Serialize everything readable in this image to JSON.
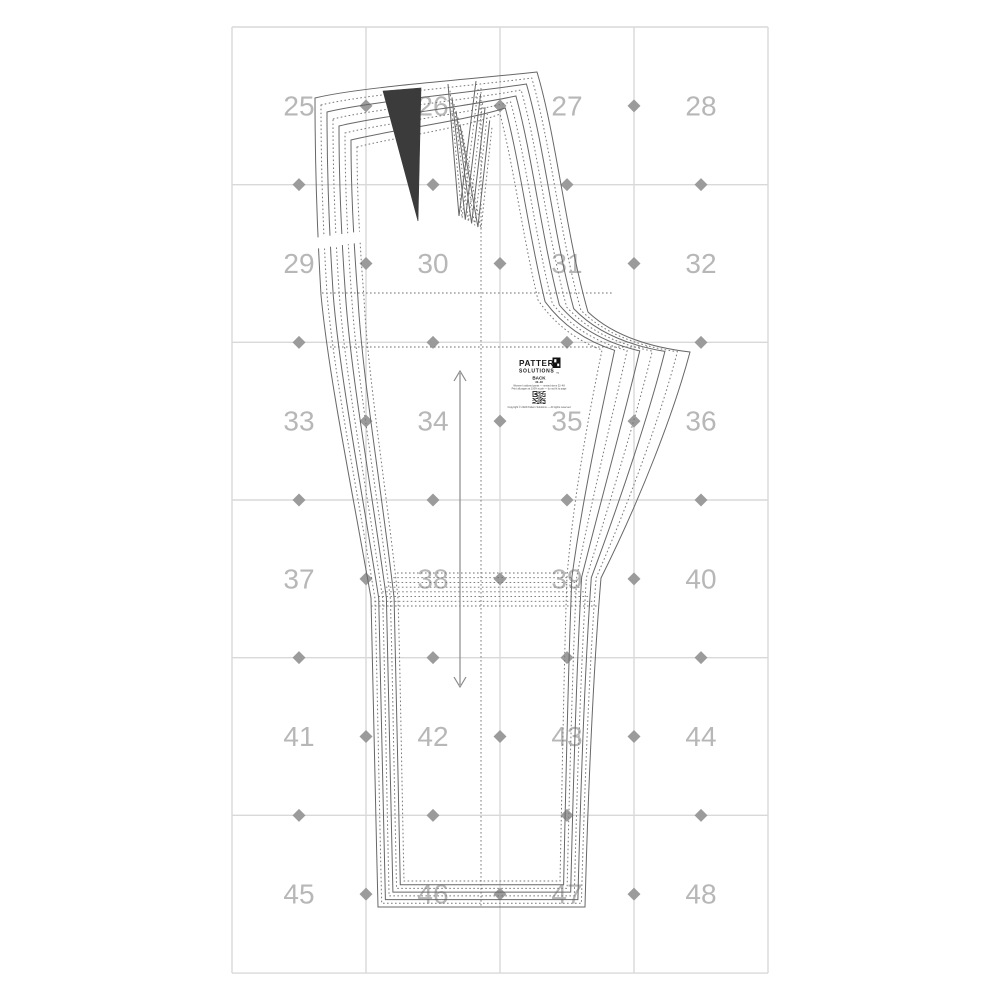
{
  "page": {
    "width": 1000,
    "height": 1000,
    "background": "#ffffff",
    "title": "Sewing pattern tiled print sheet - pants back piece"
  },
  "grid": {
    "x0": 232,
    "y0": 27,
    "cols": 4,
    "rows": 6,
    "cell_w": 134,
    "cell_h": 157.67,
    "line_color": "#d9d9d9",
    "line_width": 1.4,
    "number_color": "#b7b7b7",
    "number_size": 28,
    "page_numbers": [
      "25",
      "26",
      "27",
      "28",
      "29",
      "30",
      "31",
      "32",
      "33",
      "34",
      "35",
      "36",
      "37",
      "38",
      "39",
      "40",
      "41",
      "42",
      "43",
      "44",
      "45",
      "46",
      "47",
      "48"
    ],
    "marker": {
      "shape": "diamond",
      "color": "#9b9b9b",
      "size": 13
    }
  },
  "pattern_piece": {
    "name": "pants back - nested sizes",
    "sizes_count": 8,
    "stroke_solid": "#676767",
    "stroke_dashed": "#787878",
    "stroke_width": 1,
    "dash_array": "1.6 2.4",
    "dart_fill": "#3b3b3b",
    "guide_color": "#6f6f6f",
    "outline_outer": {
      "waistL": [
        315,
        98
      ],
      "w1": [
        360,
        87
      ],
      "w2": [
        465,
        80
      ],
      "cbTop": [
        537,
        72
      ],
      "cb1": [
        556,
        135
      ],
      "cb2": [
        566,
        235
      ],
      "crotchMid": [
        588,
        312
      ],
      "cb3": [
        622,
        344
      ],
      "crotchTip": [
        690,
        352
      ],
      "in1": [
        674,
        412
      ],
      "in2": [
        641,
        498
      ],
      "knee": [
        601,
        578
      ],
      "in3": [
        594,
        660
      ],
      "in4": [
        588,
        790
      ],
      "hemR": [
        585,
        907
      ],
      "hemL": [
        378,
        907
      ],
      "lo1": [
        375,
        790
      ],
      "lo2": [
        373,
        660
      ],
      "kneeL": [
        371,
        598
      ],
      "up1": [
        350,
        478
      ],
      "up2": [
        329,
        378
      ],
      "hipL": [
        321,
        295
      ],
      "q1": [
        315,
        195
      ]
    },
    "outline_inner": {
      "waistL": [
        357,
        147
      ],
      "w1": [
        392,
        138
      ],
      "w2": [
        468,
        127
      ],
      "cbTop": [
        500,
        114
      ],
      "cb1": [
        514,
        168
      ],
      "cb2": [
        522,
        232
      ],
      "crotchMid": [
        538,
        300
      ],
      "cb3": [
        562,
        335
      ],
      "crotchTip": [
        602,
        350
      ],
      "in1": [
        591,
        404
      ],
      "in2": [
        574,
        490
      ],
      "knee": [
        567,
        577
      ],
      "in3": [
        564,
        660
      ],
      "in4": [
        562,
        790
      ],
      "hemR": [
        560,
        881
      ],
      "hemL": [
        404,
        881
      ],
      "lo1": [
        402,
        790
      ],
      "lo2": [
        400,
        660
      ],
      "kneeL": [
        398,
        598
      ],
      "up1": [
        385,
        478
      ],
      "up2": [
        368,
        378
      ],
      "hipL": [
        364,
        298
      ],
      "q1": [
        357,
        210
      ]
    },
    "dart_dark": {
      "p1": [
        383,
        91
      ],
      "p2": [
        421,
        88
      ],
      "tip": [
        418,
        221
      ]
    },
    "dart_fan_outer": {
      "tl": [
        448,
        84
      ],
      "pt": [
        459,
        216
      ],
      "tr": [
        476,
        81
      ]
    },
    "dart_fan_inner": {
      "tl": [
        462,
        131
      ],
      "pt": [
        481,
        229
      ],
      "tr": [
        492,
        127
      ]
    },
    "hip_lines": [
      {
        "x1": 322,
        "x2": 612,
        "y": 293
      },
      {
        "x1": 330,
        "x2": 650,
        "y": 347
      }
    ],
    "knee_band_outer": {
      "x1": 371,
      "x2": 599,
      "y": 606
    },
    "knee_band_inner": {
      "x1": 397,
      "x2": 568,
      "y": 573
    },
    "crease_line": {
      "x": 481,
      "y1": 88,
      "y2": 906
    },
    "gap_band": {
      "x": 294,
      "y": 236,
      "w": 68,
      "h": 11,
      "angle": -8
    }
  },
  "grain_line": {
    "x": 460,
    "y1": 371,
    "y2": 687,
    "color": "#8a8a8a",
    "meaning": "grainline double arrow"
  },
  "label": {
    "brand_line1": "PATTERN",
    "brand_line2": "SOLUTIONS",
    "trademark": "™",
    "piece_name": "BACK",
    "size_range": "32–48",
    "info_line1": "Women's tailored pants — nested sizes 32–48",
    "info_line2": "Print all pages at 100% scale — do not fit to page",
    "copyright": "Copyright © 2024 Pattern Solutions — All rights reserved",
    "text_color": "#1a1a1a",
    "fine_text_color": "#4a4a4a",
    "qr_matrix": [
      "1111101010111",
      "1000101100100",
      "1011101011101",
      "1011100100101",
      "1000110101001",
      "1111101010111",
      "0000010110000",
      "1101110101101",
      "0110001011010",
      "1011010110111",
      "0001101010001",
      "1110010110101",
      "1010111010111"
    ]
  }
}
